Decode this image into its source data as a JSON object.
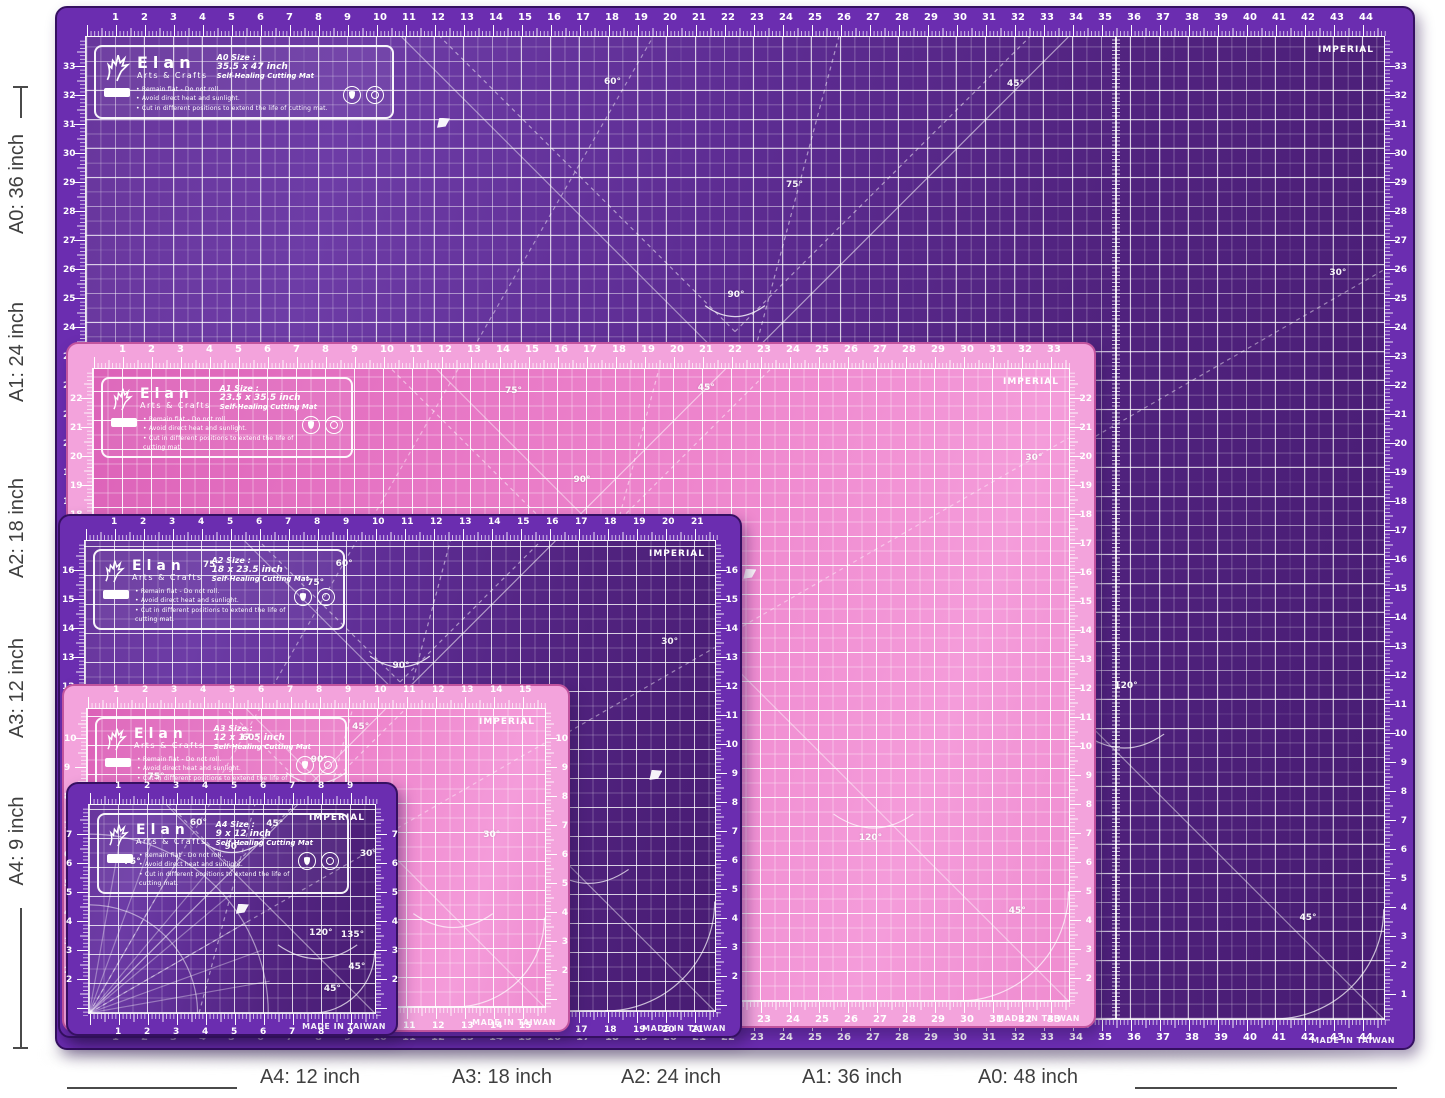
{
  "page": {
    "background": "#ffffff"
  },
  "shared": {
    "brand": "Elan",
    "brand_sub": "Arts & Crafts",
    "subtitle": "Self-Healing Cutting Mat",
    "bullets": [
      "• Remain flat - Do not roll.",
      "• Avoid direct heat and sunlight.",
      "• Cut in different positions to extend the life of cutting mat."
    ],
    "imperial": "IMPERIAL",
    "made_in": "MADE IN TAIWAN",
    "icons": [
      "elan-deer-logo",
      "droplet-icon",
      "ring-icon",
      "warning-badge",
      "flag-icon"
    ]
  },
  "colors": {
    "purple": {
      "band": "#6b2db0",
      "rim": "#351061",
      "body": "linear-gradient(105deg,#68369c 0%,#6d3ca6 18%,#5e2d94 42%,#51237f 68%,#481c73 100%)",
      "line": "rgba(255,255,255,0.72)",
      "half": "rgba(255,255,255,0.24)"
    },
    "pink": {
      "band": "#f3a3dc",
      "rim": "#c2549e",
      "body": "linear-gradient(108deg,#dc62b8 0%,#e675c4 28%,#ee86cd 55%,#f49cda 82%,#ef8cd0 100%)",
      "line": "rgba(255,255,255,0.85)",
      "half": "rgba(255,255,255,0.38)"
    }
  },
  "mats": [
    {
      "id": "a0",
      "theme": "purple",
      "x": 55,
      "y": 6,
      "w": 1360,
      "h": 1044,
      "inset": 30,
      "z": 1,
      "size_label": "A0 Size :",
      "size_inches": "35.5 x 47 inch",
      "top_max": 46,
      "side_start": 33,
      "fold_inch": 35.5,
      "angles": [
        {
          "t": "75°",
          "x": 0.545,
          "y": 0.15
        },
        {
          "t": "60°",
          "x": 0.405,
          "y": 0.046
        },
        {
          "t": "45°",
          "x": 0.715,
          "y": 0.048
        },
        {
          "t": "90°",
          "x": 0.5,
          "y": 0.262
        },
        {
          "t": "30°",
          "x": 0.963,
          "y": 0.24
        },
        {
          "t": "120°",
          "x": 0.8,
          "y": 0.66
        },
        {
          "t": "45°",
          "x": 0.94,
          "y": 0.895
        }
      ],
      "flag": {
        "x": 0.27,
        "y": 0.082
      }
    },
    {
      "id": "a1",
      "theme": "pink",
      "x": 66,
      "y": 342,
      "w": 1030,
      "h": 686,
      "inset": 26,
      "z": 2,
      "size_label": "A1 Size :",
      "size_inches": "23.5 x 35.5 inch",
      "top_max": 35,
      "side_start": 22,
      "angles": [
        {
          "t": "75°",
          "x": 0.43,
          "y": 0.035
        },
        {
          "t": "45°",
          "x": 0.627,
          "y": 0.03
        },
        {
          "t": "30°",
          "x": 0.962,
          "y": 0.14
        },
        {
          "t": "90°",
          "x": 0.5,
          "y": 0.175
        },
        {
          "t": "120°",
          "x": 0.795,
          "y": 0.74
        },
        {
          "t": "45°",
          "x": 0.945,
          "y": 0.855
        }
      ],
      "flag": {
        "x": 0.665,
        "y": 0.315
      }
    },
    {
      "id": "a2",
      "theme": "purple",
      "x": 58,
      "y": 514,
      "w": 684,
      "h": 524,
      "inset": 26,
      "z": 3,
      "size_label": "A2 Size :",
      "size_inches": "18 x 23.5 inch",
      "top_max": 23,
      "side_start": 16,
      "angles": [
        {
          "t": "75°",
          "x": 0.2,
          "y": 0.05
        },
        {
          "t": "60°",
          "x": 0.41,
          "y": 0.048
        },
        {
          "t": "75°",
          "x": 0.365,
          "y": 0.09
        },
        {
          "t": "90°",
          "x": 0.5,
          "y": 0.265
        },
        {
          "t": "30°",
          "x": 0.925,
          "y": 0.215
        },
        {
          "t": "120°",
          "x": 0.6,
          "y": 0.55
        }
      ],
      "flag": {
        "x": 0.893,
        "y": 0.485
      }
    },
    {
      "id": "a3",
      "theme": "pink",
      "x": 62,
      "y": 684,
      "w": 508,
      "h": 348,
      "inset": 24,
      "z": 4,
      "size_label": "A3 Size :",
      "size_inches": "12 x 17.5 inch",
      "top_max": 17,
      "side_start": 10,
      "angles": [
        {
          "t": "60°",
          "x": 0.355,
          "y": 0.095
        },
        {
          "t": "45°",
          "x": 0.595,
          "y": 0.06
        },
        {
          "t": "90°",
          "x": 0.505,
          "y": 0.17
        },
        {
          "t": "75°",
          "x": 0.15,
          "y": 0.225
        },
        {
          "t": "30°",
          "x": 0.88,
          "y": 0.42
        }
      ],
      "flag": {
        "x": 0.455,
        "y": 0.33
      }
    },
    {
      "id": "a4",
      "theme": "purple",
      "x": 66,
      "y": 782,
      "w": 332,
      "h": 254,
      "inset": 22,
      "z": 5,
      "protractor": true,
      "size_label": "A4 Size :",
      "size_inches": "9 x 12 inch",
      "top_max": 11,
      "side_start": 7,
      "angles": [
        {
          "t": "60°",
          "x": 0.38,
          "y": 0.085
        },
        {
          "t": "45°",
          "x": 0.645,
          "y": 0.09
        },
        {
          "t": "90°",
          "x": 0.5,
          "y": 0.2
        },
        {
          "t": "75°",
          "x": 0.15,
          "y": 0.27
        },
        {
          "t": "30°",
          "x": 0.97,
          "y": 0.235
        },
        {
          "t": "120°",
          "x": 0.805,
          "y": 0.61
        },
        {
          "t": "135°",
          "x": 0.915,
          "y": 0.62
        },
        {
          "t": "45°",
          "x": 0.93,
          "y": 0.77
        },
        {
          "t": "45°",
          "x": 0.845,
          "y": 0.875
        }
      ],
      "flag": {
        "x": 0.51,
        "y": 0.47
      }
    }
  ],
  "dimension_labels": {
    "color": "#3f3f3f",
    "left": [
      {
        "text": "A0: 36 inch",
        "cy": 184
      },
      {
        "text": "A1: 24 inch",
        "cy": 352
      },
      {
        "text": "A2: 18 inch",
        "cy": 528
      },
      {
        "text": "A3: 12 inch",
        "cy": 688
      },
      {
        "text": "A4: 9 inch",
        "cy": 841
      }
    ],
    "bottom": [
      {
        "text": "A4: 12 inch",
        "cx": 310
      },
      {
        "text": "A3: 18 inch",
        "cx": 502
      },
      {
        "text": "A2: 24 inch",
        "cx": 671
      },
      {
        "text": "A1: 36 inch",
        "cx": 852
      },
      {
        "text": "A0: 48 inch",
        "cx": 1028
      }
    ]
  }
}
